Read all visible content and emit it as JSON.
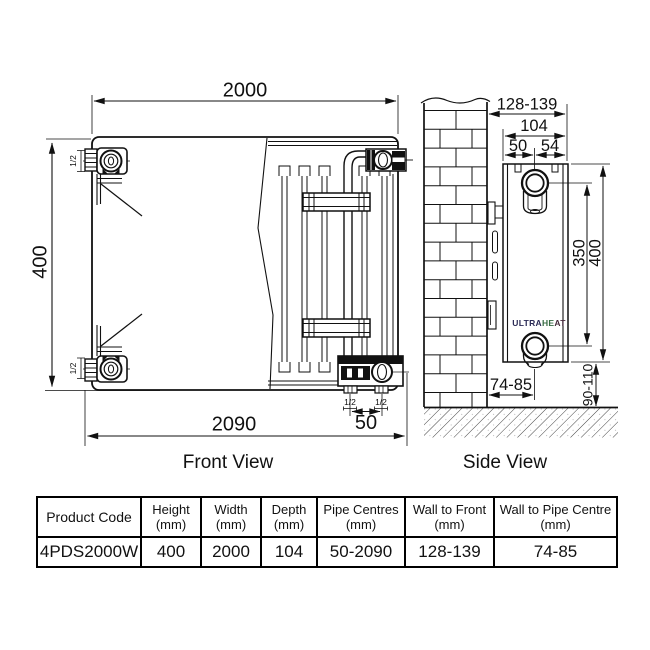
{
  "front_view": {
    "title": "Front View",
    "dim_width_top": "2000",
    "dim_height": "400",
    "dim_overall_width": "2090",
    "dim_pipe_centres": "50",
    "conn_top_left": "1/2",
    "conn_bottom_left": "1/2",
    "conn_bottom_right_a": "1/2",
    "conn_bottom_right_b": "1/2"
  },
  "side_view": {
    "title": "Side View",
    "dim_wall_to_front": "128-139",
    "dim_depth": "104",
    "dim_back_to_pipe": "50",
    "dim_pipe_to_front": "54",
    "dim_pipe_centres": "350",
    "dim_height": "400",
    "dim_floor_clearance": "90-110",
    "dim_wall_to_pipe": "74-85",
    "brand": {
      "part1": "ULTRA",
      "part2": "HE",
      "part3": "AT"
    }
  },
  "table": {
    "headers": [
      {
        "title": "Product Code",
        "unit": ""
      },
      {
        "title": "Height",
        "unit": "(mm)"
      },
      {
        "title": "Width",
        "unit": "(mm)"
      },
      {
        "title": "Depth",
        "unit": "(mm)"
      },
      {
        "title": "Pipe Centres",
        "unit": "(mm)"
      },
      {
        "title": "Wall to Front",
        "unit": "(mm)"
      },
      {
        "title": "Wall to Pipe Centre",
        "unit": "(mm)"
      }
    ],
    "row": {
      "product_code": "4PDS2000W",
      "height": "400",
      "width": "2000",
      "depth": "104",
      "pipe_centres": "50-2090",
      "wall_to_front": "128-139",
      "wall_to_pipe_centre": "74-85"
    }
  },
  "colors": {
    "line": "#111111",
    "brand_navy": "#2a2a55",
    "brand_green": "#376b43",
    "brand_dark": "#44283a"
  }
}
